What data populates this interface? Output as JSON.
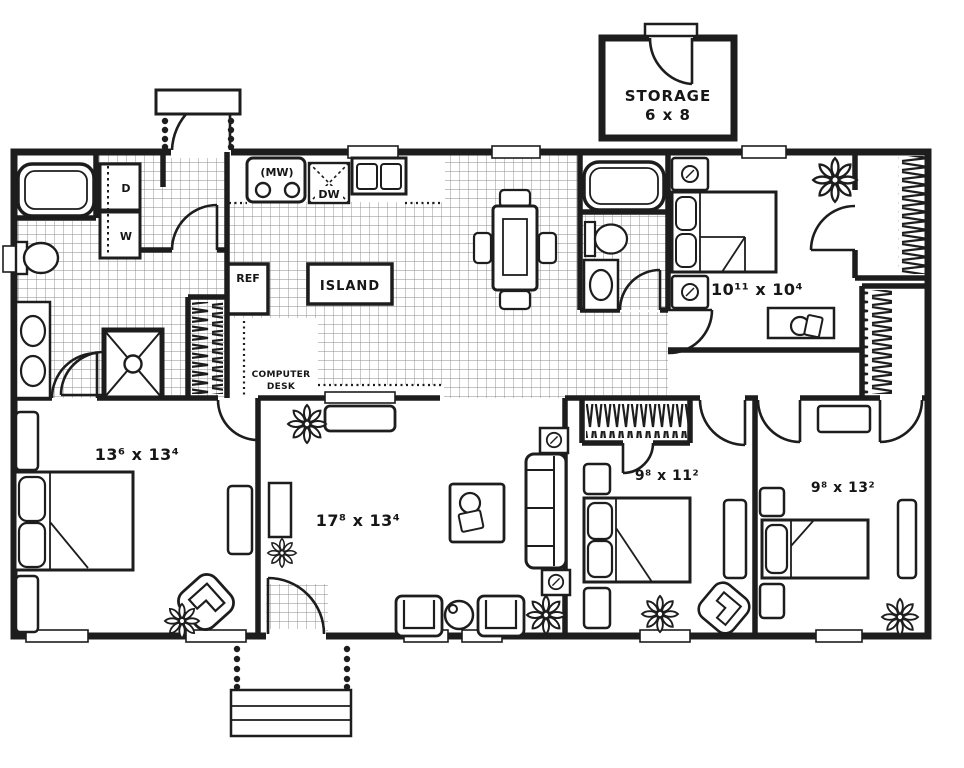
{
  "plan_type": "single-story house floor plan",
  "colors": {
    "ink": "#1d1d1d",
    "paper": "#ffffff",
    "tile_line": "#8a8a8a"
  },
  "storage": {
    "name": "STORAGE",
    "size": "6 x 8"
  },
  "rooms": {
    "bedroom_master": "13⁶ x 13⁴",
    "living": "17⁸ x 13⁴",
    "bedroom_top_right": "10¹¹ x 10⁴",
    "bedroom_middle": "9⁸ x 11²",
    "bedroom_right": "9⁸ x 13²"
  },
  "kitchen": {
    "island": "ISLAND",
    "refrigerator": "REF",
    "microwave": "(MW)",
    "dishwasher": "DW",
    "computer_desk_line1": "COMPUTER",
    "computer_desk_line2": "DESK"
  },
  "laundry": {
    "dryer": "D",
    "washer": "W"
  }
}
